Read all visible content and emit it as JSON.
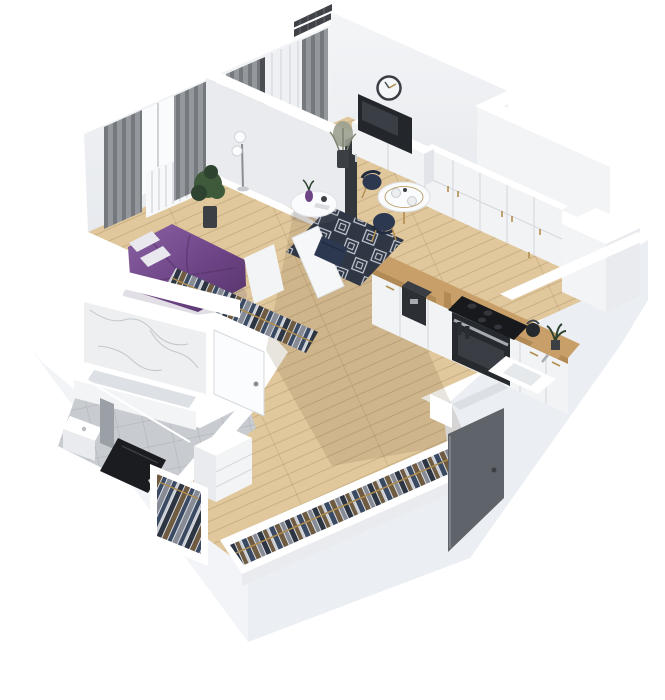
{
  "scene": {
    "type": "isometric-3d-apartment-floor-plan-render",
    "background": "#ffffff",
    "rooms": [
      {
        "name": "bedroom",
        "furniture": [
          "double-bed-purple-duvet",
          "white-pillows",
          "gray-curtains",
          "window",
          "white-radiator",
          "potted-plant",
          "open-closet-hanging-clothes"
        ]
      },
      {
        "name": "living-room",
        "furniture": [
          "wall-clock",
          "flat-tv",
          "white-tv-sideboard",
          "dried-plant-vase",
          "floor-lamp",
          "round-white-coffee-table",
          "purple-vase",
          "navy-pouf",
          "navy-diamond-pattern-rug",
          "round-dining-table",
          "navy-dining-chairs",
          "balcony-door-with-sheer-curtains",
          "balcony-mesh-screen"
        ]
      },
      {
        "name": "kitchen",
        "furniture": [
          "white-upper-cabinets",
          "white-lower-cabinets",
          "wood-countertop",
          "built-in-oven",
          "black-cooktop",
          "coffee-machine",
          "cutting-boards",
          "kettle",
          "sink-basin",
          "ventilation-shaft-box"
        ]
      },
      {
        "name": "bathroom",
        "furniture": [
          "marble-accent-wall",
          "bathtub",
          "washbasin",
          "gray-partition-panel",
          "dark-shower-tray",
          "open-white-door",
          "gray-floor-tiles"
        ]
      },
      {
        "name": "hallway",
        "furniture": [
          "long-open-wardrobe-hanging-clothes",
          "small-open-wardrobe-hanging-clothes",
          "white-dresser",
          "entrance-door-open-dark-gray"
        ]
      }
    ]
  },
  "palette": {
    "bg": "#ffffff",
    "wallTop": "#ffffff",
    "faceLight": "#f3f4f6",
    "faceMid": "#e9ebee",
    "faceShade": "#dcdfe4",
    "faceDark": "#caced4",
    "wood": "#e0c79c",
    "woodShadow": "rgba(115,88,50,0.16)",
    "tile": "#c8ccd0",
    "marble": "#edeff1",
    "marbleVein": "#c2c7cc",
    "purple": "#6d4486",
    "purpleLight": "#8a62a3",
    "purpleDark": "#553468",
    "pillow": "#e9e8ee",
    "curtain": "#94989d",
    "curtainDark": "#75797e",
    "windowGlow": "#fafbfc",
    "plant": "#3f5a3b",
    "plantDark": "#2e4230",
    "pot": "#3c3f44",
    "clockFace": "#f5f6f7",
    "clockRim": "#3a3e43",
    "tvDark": "#23262b",
    "navy": "#2c3850",
    "navyDark": "#212b40",
    "gold": "#b08d4f",
    "rugBase": "#303744",
    "rugLine": "#cbd0d9",
    "counterWood": "#c89f68",
    "counterWoodDark": "#b18a55",
    "cabinet": "#f2f3f5",
    "cabinetShade": "#e2e4e9",
    "seam": "#d3d6db",
    "applianceDark": "#26292d",
    "steel": "#a5abb1",
    "doorGray": "#5f646a",
    "showerDark": "#1a1c1f",
    "clothesA": "#3b4a63",
    "clothesB": "#6e5b41",
    "clothesC": "#868b95",
    "clothesD": "#2d3542",
    "mesh": "#3f4347"
  }
}
